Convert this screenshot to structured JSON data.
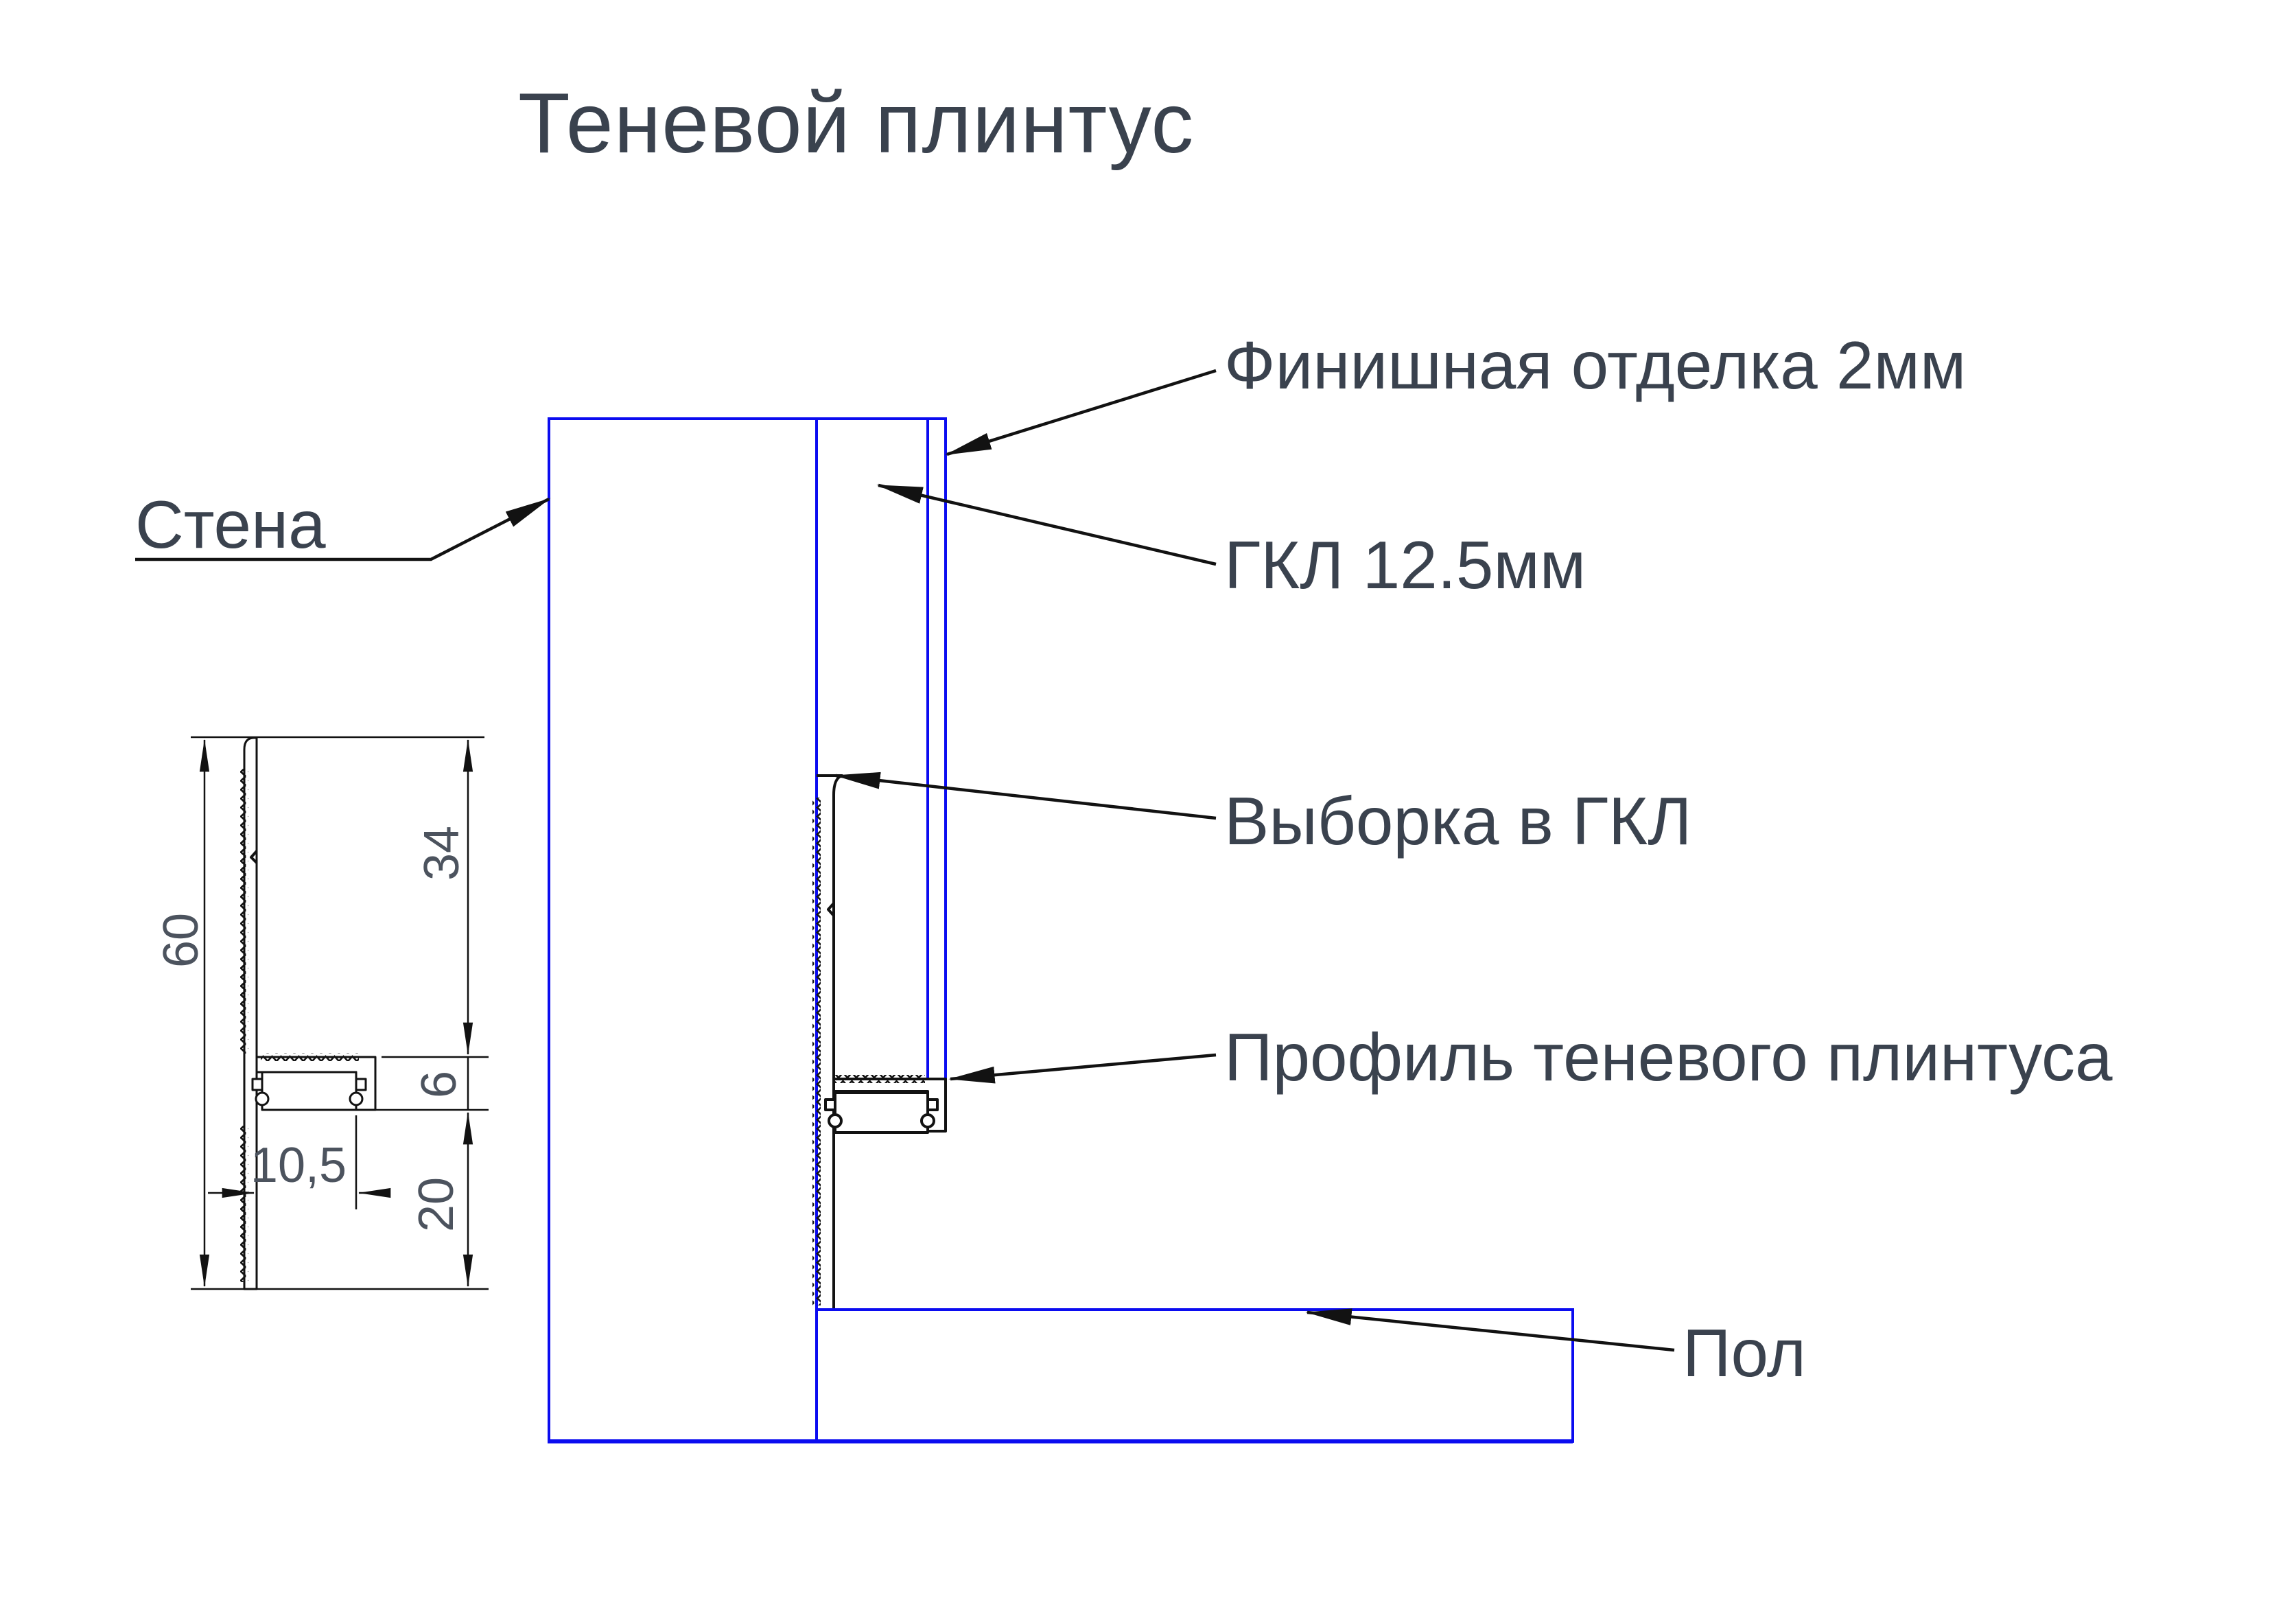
{
  "title": "Теневой плинтус",
  "colors": {
    "text": "#3a424e",
    "dim_text": "#4c535e",
    "blue": "#0b0cf0",
    "hatch": "#6d6d6d",
    "line": "#121212"
  },
  "labels": {
    "wall": "Стена",
    "finish": "Финишная отделка 2мм",
    "gkl": "ГКЛ 12.5мм",
    "cutout": "Выборка в ГКЛ",
    "profile": "Профиль теневого плинтуса",
    "floor": "Пол"
  },
  "dimensions": {
    "total_height": "60",
    "upper_segment": "34",
    "channel_segment": "6",
    "lower_segment": "20",
    "channel_width": "10,5"
  }
}
